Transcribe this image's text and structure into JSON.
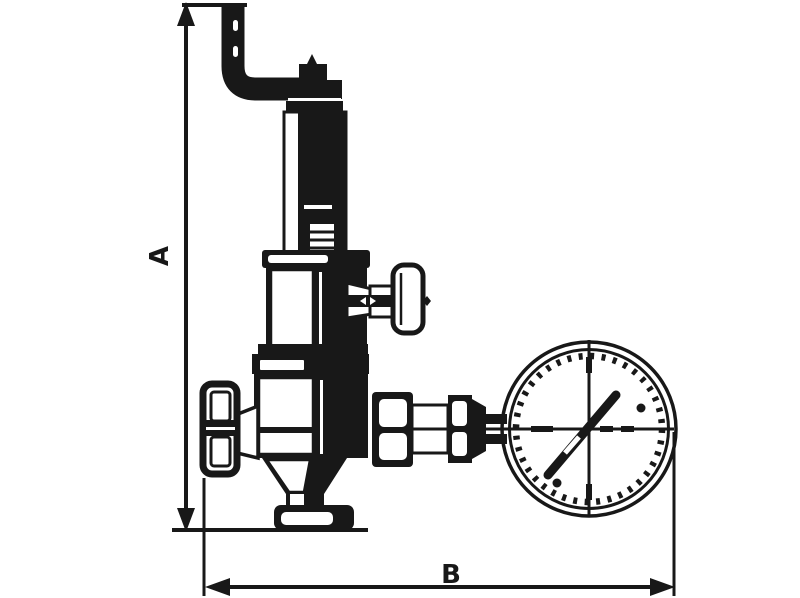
{
  "diagram": {
    "kind": "technical-line-drawing",
    "subject": "safety relief valve with pressure gauge",
    "ink_color": "#181818",
    "background_color": "#ffffff",
    "dimension_labels": {
      "vertical": "A",
      "horizontal": "B"
    },
    "parts": [
      "lever-pipe",
      "spindle-cap",
      "adjusting-spindle",
      "spring-bonnet",
      "side-tap-handle",
      "valve-body",
      "inlet-cap",
      "outlet-union",
      "connector-pipe",
      "pressure-gauge",
      "gauge-needle",
      "bottom-flange"
    ]
  }
}
